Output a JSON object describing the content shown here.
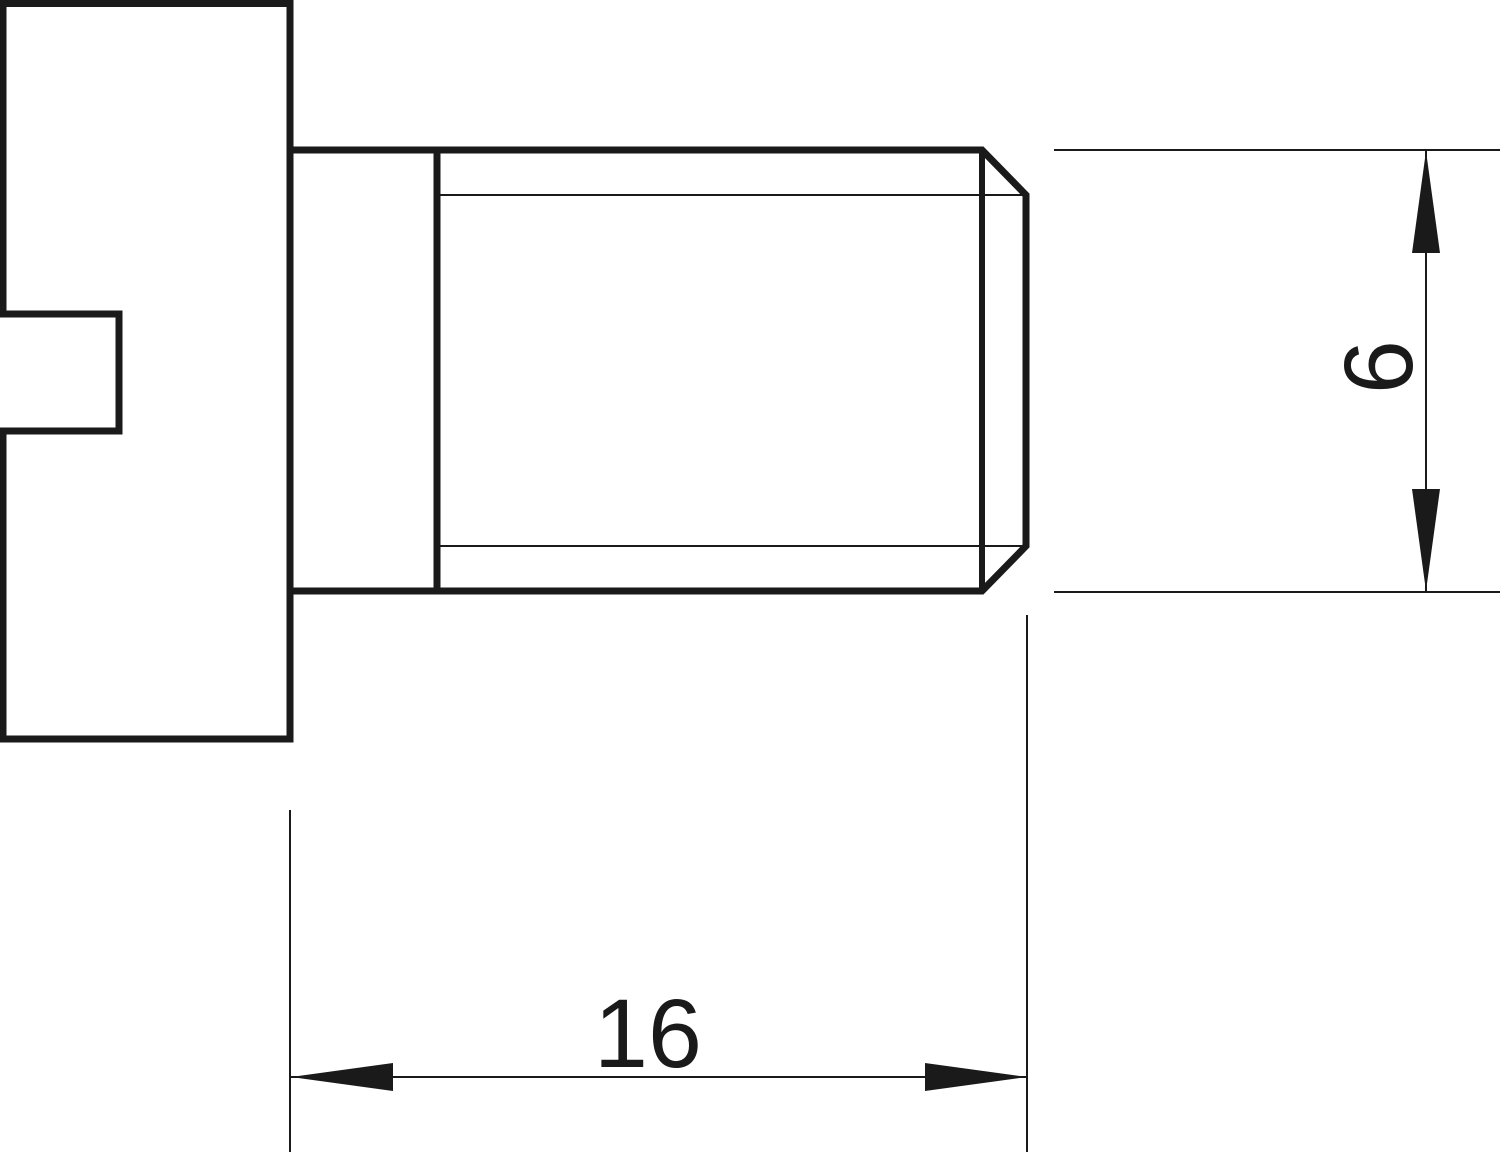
{
  "canvas": {
    "width": 1500,
    "height": 1152,
    "background": "#ffffff",
    "line_color": "#1a1a1a"
  },
  "drawing": {
    "type": "technical-drawing",
    "subject": "slotted-head screw, side elevation view"
  },
  "dims": {
    "length": {
      "value": "16",
      "orientation": "horizontal"
    },
    "diameter": {
      "value": "6",
      "orientation": "vertical"
    }
  }
}
